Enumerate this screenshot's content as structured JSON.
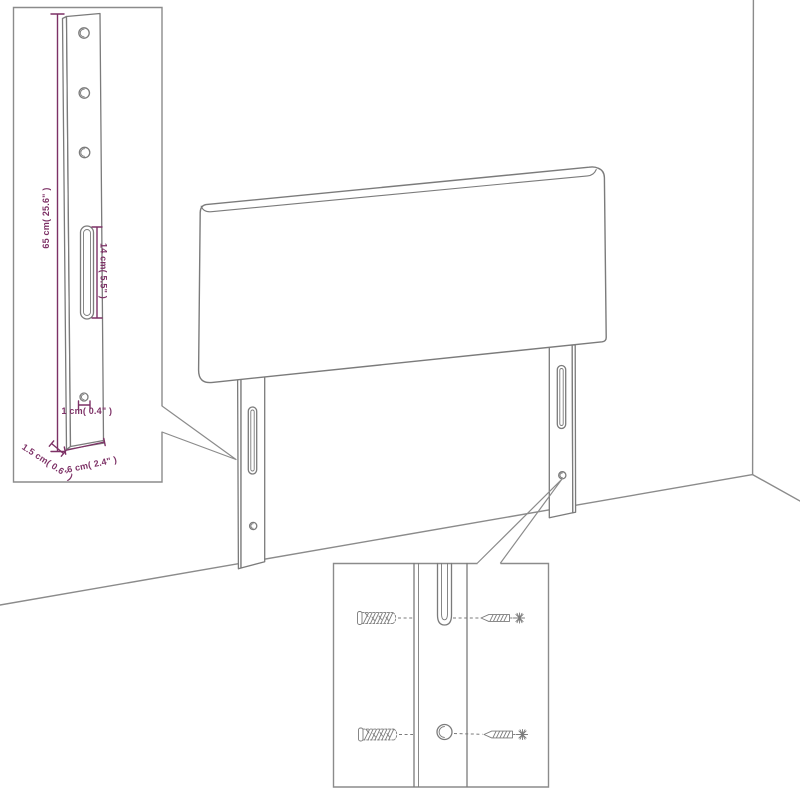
{
  "colors": {
    "line": "#7b7b7b",
    "wall": "#8b8b8b",
    "dimension": "#7d3166",
    "background": "#ffffff"
  },
  "dimension_inset": {
    "height_label": "65 cm( 25.6\" )",
    "slot_height_label": "14 cm( 5.5\" )",
    "hole_diameter_label": "1 cm( 0.4\" )",
    "side_depth_label": "1.5 cm( 0.6\" )",
    "width_label": "6 cm( 2.4\" )"
  }
}
